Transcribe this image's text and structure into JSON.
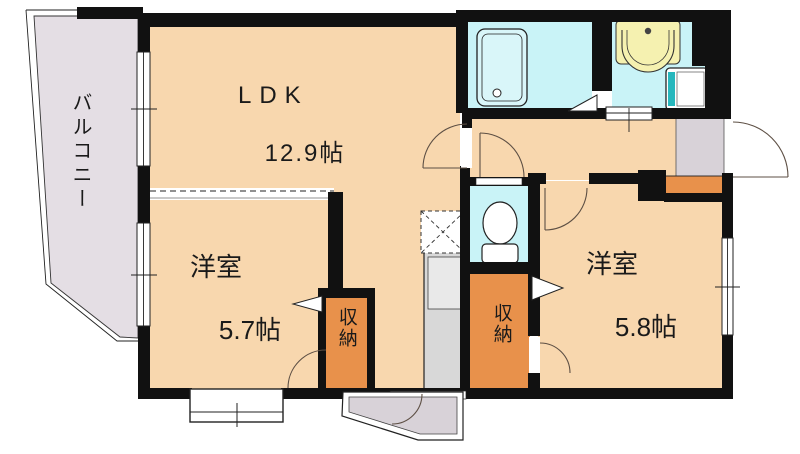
{
  "floorplan": {
    "title": "2LDK apartment floor plan",
    "balcony": {
      "label": "バルコニー"
    },
    "ldk": {
      "label": "LDK",
      "size": "12.9帖"
    },
    "bedroom_left": {
      "label": "洋室",
      "size": "5.7帖"
    },
    "bedroom_right": {
      "label": "洋室",
      "size": "5.8帖"
    },
    "storage_left": {
      "label": "収納"
    },
    "storage_right": {
      "label": "収納"
    },
    "fixtures": [
      "bathtub",
      "washbasin",
      "washing-machine",
      "toilet",
      "kitchen-counter",
      "refrigerator-space",
      "shoe-cabinet",
      "entrance-door",
      "bay-window",
      "porch"
    ]
  },
  "colors": {
    "wall": "#111111",
    "floor": "#f8d7ae",
    "wet": "#c9f3f7",
    "storage": "#e8914b",
    "balcony": "#e4dee4",
    "tile": "#d8d2d8",
    "counter": "#d8d8d8",
    "basin_yellow": "#f5f1b0",
    "appliance_teal": "#27b7bd",
    "arc": "#5d4f44"
  }
}
